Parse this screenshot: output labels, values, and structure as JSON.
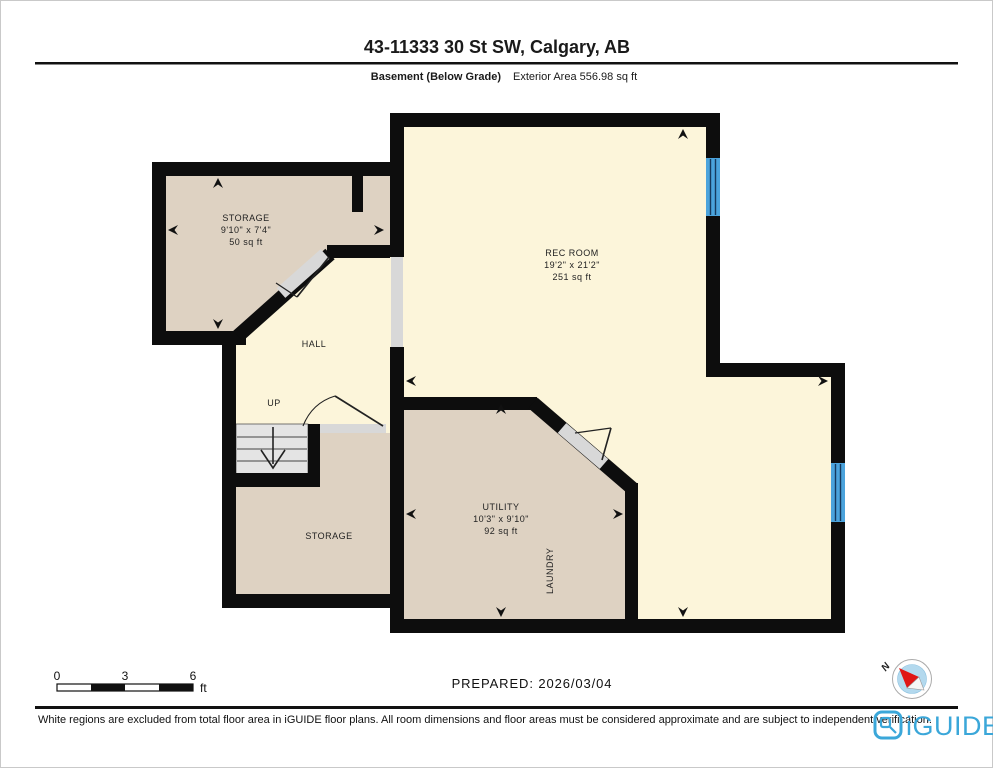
{
  "header": {
    "title": "43-11333 30 St SW, Calgary, AB",
    "floor_label": "Basement (Below Grade)",
    "area_label": "Exterior Area 556.98 sq ft"
  },
  "rooms": {
    "storage_upper": {
      "name": "STORAGE",
      "dims": "9'10\" x 7'4\"",
      "area": "50 sq ft"
    },
    "rec_room": {
      "name": "REC ROOM",
      "dims": "19'2\" x 21'2\"",
      "area": "251 sq ft"
    },
    "hall": {
      "name": "HALL"
    },
    "stairs": {
      "label": "UP"
    },
    "storage_lower": {
      "name": "STORAGE"
    },
    "utility": {
      "name": "UTILITY",
      "dims": "10'3\" x 9'10\"",
      "area": "92 sq ft"
    },
    "laundry": {
      "name": "LAUNDRY"
    }
  },
  "scale_bar": {
    "ticks": [
      "0",
      "3",
      "6"
    ],
    "unit": "ft"
  },
  "prepared_label": "PREPARED: 2026/03/04",
  "compass": {
    "north_label": "N"
  },
  "footer": {
    "disclaimer": "White regions are excluded from total floor area in iGUIDE floor plans. All room dimensions and floor areas must be considered approximate and are subject to independent verification.",
    "brand": "iGUIDE"
  },
  "colors": {
    "wall": "#0d0d0d",
    "room_tan": "#ded2c2",
    "room_cream": "#fcf5da",
    "stairs_gray": "#e4e4e4",
    "opening_gray": "#d8d8d8",
    "window_blue": "#4ba3dc",
    "brand_blue": "#3ba7d9",
    "compass_blue": "#b3d9ee"
  }
}
